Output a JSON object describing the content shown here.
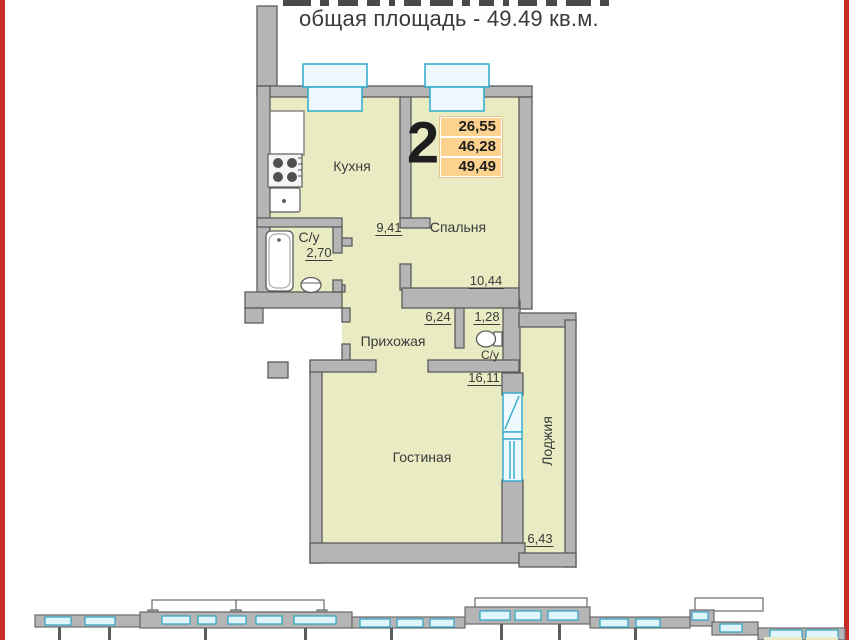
{
  "header": {
    "title": "общая площадь - 49.49 кв.м."
  },
  "apartment": {
    "number": "2",
    "area_values": [
      "26,55",
      "46,28",
      "49,49"
    ]
  },
  "rooms": {
    "kitchen": {
      "name": "Кухня",
      "area": "9,41"
    },
    "bedroom": {
      "name": "Спальня",
      "area": "10,44"
    },
    "bathroom": {
      "name": "С/у",
      "area": "2,70"
    },
    "hallway": {
      "name": "Прихожая",
      "area": "6,24"
    },
    "wc": {
      "name": "С/у",
      "area": "1,28"
    },
    "living": {
      "name": "Гостиная",
      "area": "16,11"
    },
    "loggia": {
      "name": "Лоджия",
      "area": "6,43"
    }
  },
  "colors": {
    "room_fill": "#e9ecc3",
    "wall_fill": "#b5b5b5",
    "wall_stroke": "#5c5c5c",
    "window_stroke": "#2fa9cb",
    "window_fill": "#eef9fd",
    "area_box_bg": "#fcd28e",
    "accent_red": "#c92b27",
    "text": "#3b3b3b"
  }
}
